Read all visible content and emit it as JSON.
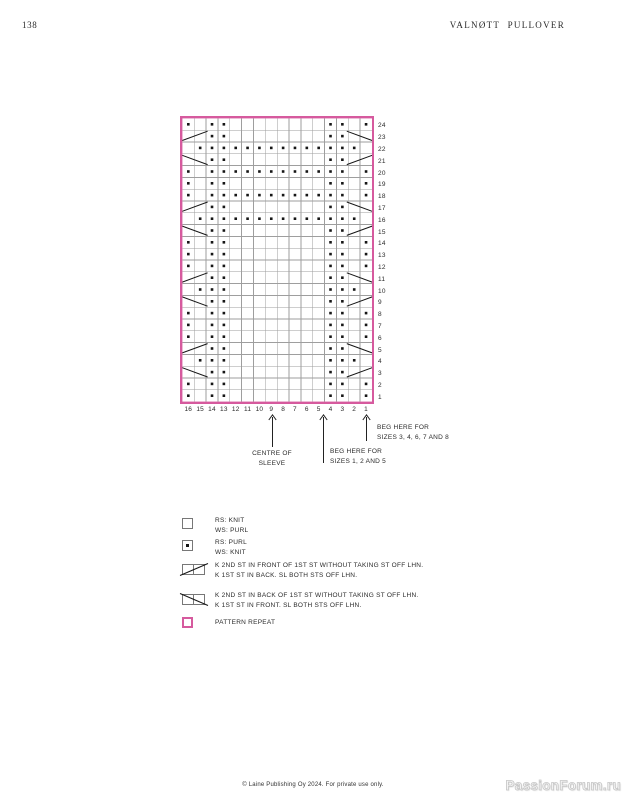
{
  "page": {
    "number": "138",
    "title": "VALNØTT PULLOVER",
    "footer": "© Laine Publishing Oy 2024. For private use only.",
    "watermark": "PassionForum.ru"
  },
  "chart_data": {
    "type": "knitting-chart",
    "title": "Valnøtt pullover sleeve chart",
    "stitch_codes": {
      "-": "knit (RS: knit, WS: purl)",
      ".": "purl (RS: purl, WS: knit)",
      "F": "k 2nd st in front of 1st st, 2-stitch right-leaning cross (spans 2 cells)",
      "B": "k 2nd st in back of 1st st, 2-stitch left-leaning cross (spans 2 cells)"
    },
    "row_labels": [
      "24",
      "23",
      "22",
      "21",
      "20",
      "19",
      "18",
      "17",
      "16",
      "15",
      "14",
      "13",
      "12",
      "11",
      "10",
      "9",
      "8",
      "7",
      "6",
      "5",
      "4",
      "3",
      "2",
      "1"
    ],
    "col_labels": [
      "16",
      "15",
      "14",
      "13",
      "12",
      "11",
      "10",
      "9",
      "8",
      "7",
      "6",
      "5",
      "4",
      "3",
      "2",
      "1"
    ],
    "cells": [
      ".-..--------..-.",
      "Ff..--------..Bb",
      "-..............-",
      "Bb..--------..Ff",
      ".-............-.",
      ".-..--------..-.",
      ".-............-.",
      "Ff..--------..Bb",
      "-..............-",
      "Bb..--------..Ff",
      ".-..--------..-.",
      ".-..--------..-.",
      ".-..--------..-.",
      "Ff..--------..Bb",
      "-...--------...-",
      "Bb..--------..Ff",
      ".-..--------..-.",
      ".-..--------..-.",
      ".-..--------..-.",
      "Ff..--------..Bb",
      "-...--------...-",
      "Bb..--------..Ff",
      ".-..--------..-.",
      ".-..--------..-."
    ],
    "colors": {
      "repeat_border": "#d65a9e",
      "grid": "#9e9e9e",
      "symbol": "#161616"
    }
  },
  "annotations": {
    "centre": {
      "lines": [
        "CENTRE OF",
        "SLEEVE"
      ]
    },
    "beg_small": {
      "lines": [
        "BEG HERE FOR",
        "SIZES 1, 2 AND 5"
      ]
    },
    "beg_large": {
      "lines": [
        "BEG HERE FOR",
        "SIZES 3, 4, 6, 7 AND 8"
      ]
    }
  },
  "legend": {
    "items": [
      {
        "symbol": "knit",
        "lines": [
          "RS: KNIT",
          "WS: PURL"
        ]
      },
      {
        "symbol": "purl",
        "lines": [
          "RS: PURL",
          "WS: KNIT"
        ]
      },
      {
        "symbol": "cable-front",
        "lines": [
          "K 2ND ST IN FRONT OF 1ST ST WITHOUT TAKING ST OFF LHN.",
          "K 1ST ST IN BACK. SL BOTH STS OFF LHN."
        ]
      },
      {
        "symbol": "cable-back",
        "lines": [
          "K 2ND ST IN BACK OF 1ST ST WITHOUT TAKING ST OFF LHN.",
          "K 1ST ST IN FRONT. SL BOTH STS OFF LHN."
        ]
      },
      {
        "symbol": "pattern-repeat",
        "lines": [
          "PATTERN REPEAT"
        ]
      }
    ]
  }
}
